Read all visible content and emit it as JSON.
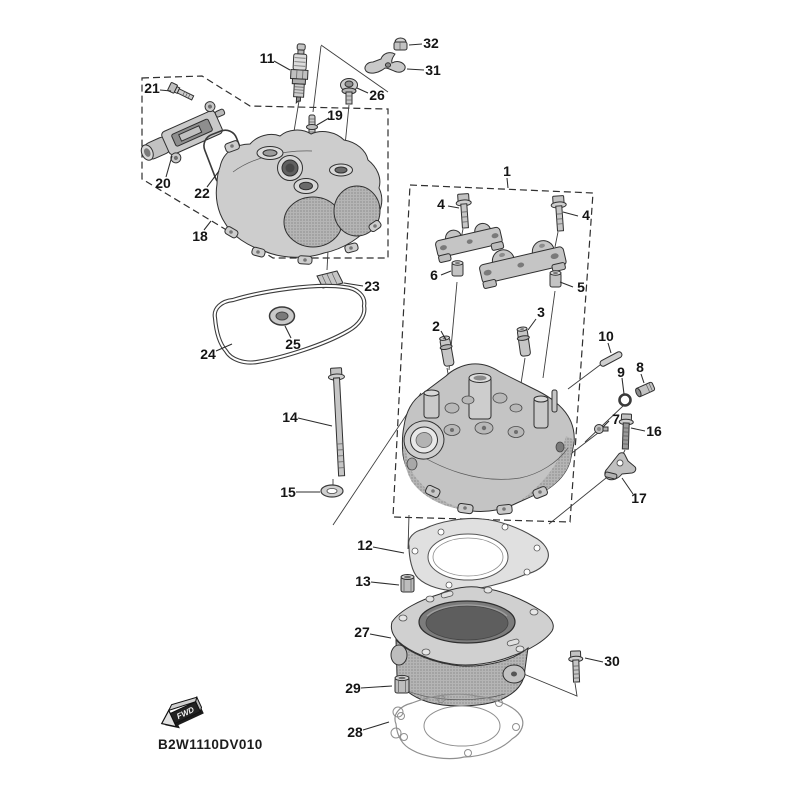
{
  "diagram": {
    "code": "B2W1110DV010",
    "fwd_marker": "FWD",
    "background": "#ffffff",
    "line_color": "#2f2f2f",
    "metal_light": "#d6d6d6",
    "metal_mid": "#c0c0c0",
    "metal_dark": "#8f8f8f"
  },
  "callouts": {
    "c1": "1",
    "c2": "2",
    "c3": "3",
    "c4a": "4",
    "c4b": "4",
    "c5": "5",
    "c6": "6",
    "c7": "7",
    "c8": "8",
    "c9": "9",
    "c10": "10",
    "c11": "11",
    "c12": "12",
    "c13": "13",
    "c14": "14",
    "c15": "15",
    "c16": "16",
    "c17": "17",
    "c18": "18",
    "c19": "19",
    "c20": "20",
    "c21": "21",
    "c22": "22",
    "c23": "23",
    "c24": "24",
    "c25": "25",
    "c26": "26",
    "c27": "27",
    "c28": "28",
    "c29": "29",
    "c30": "30",
    "c31": "31",
    "c32": "32"
  }
}
